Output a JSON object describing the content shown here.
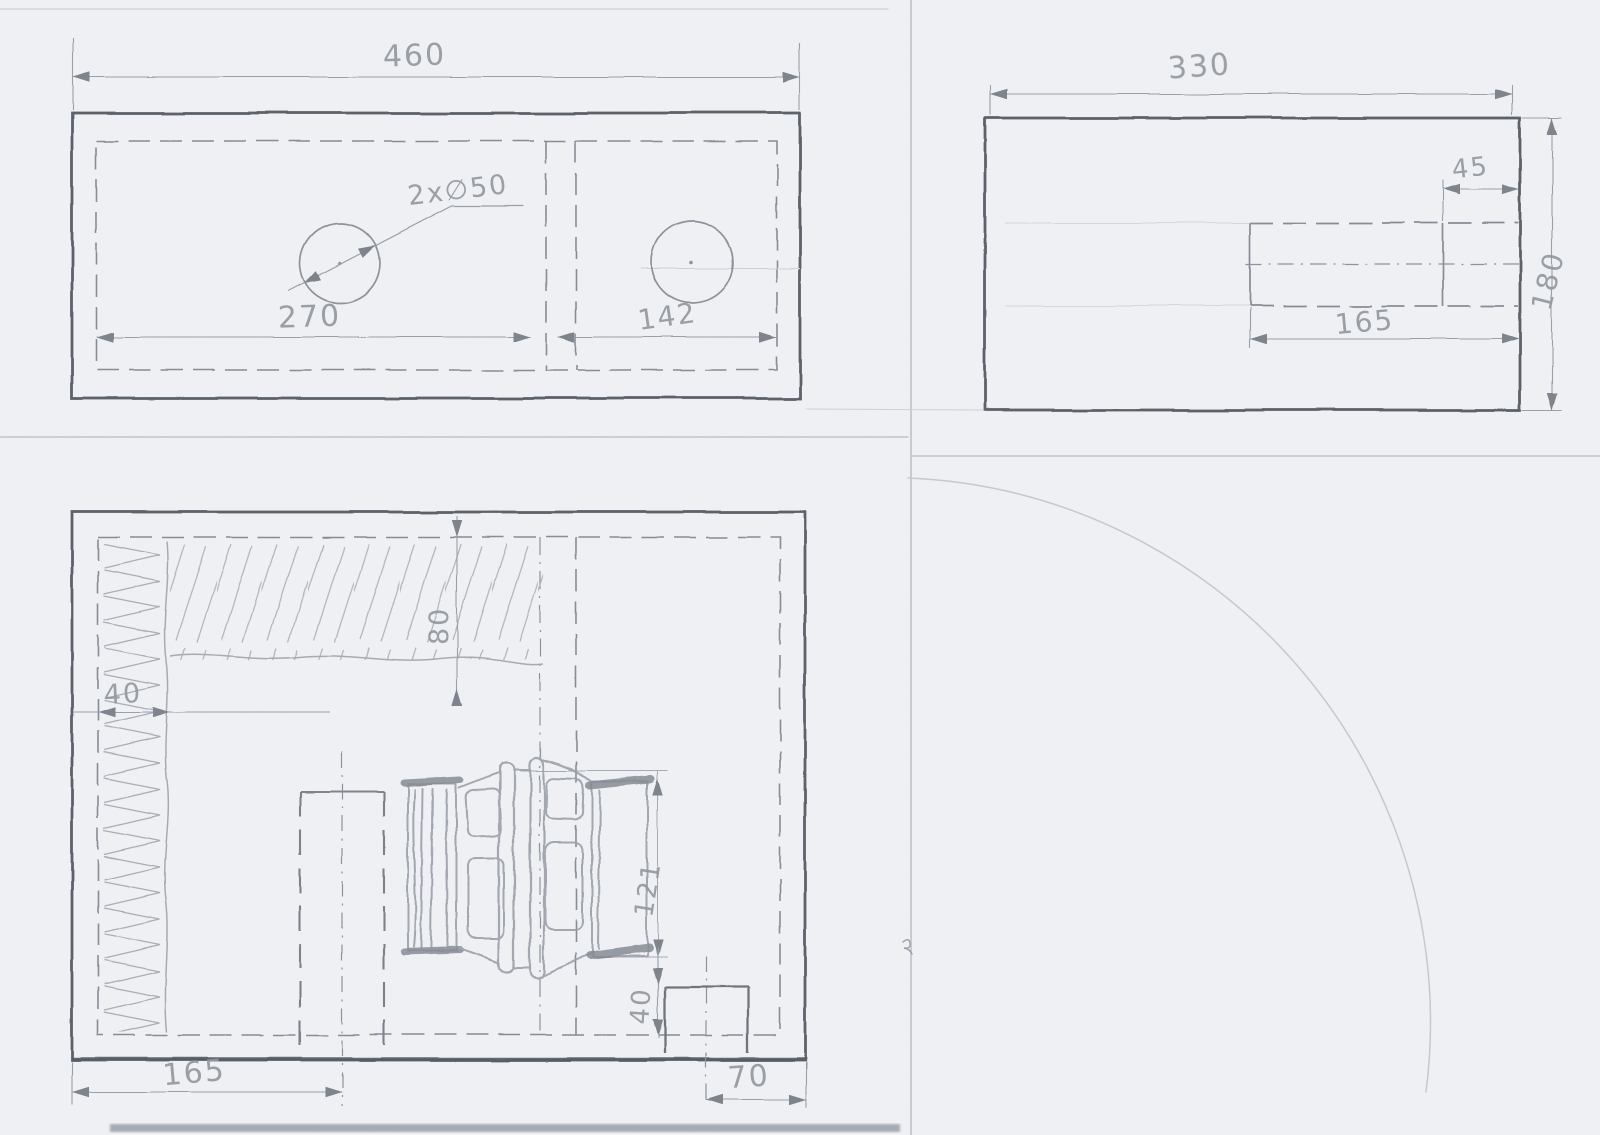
{
  "document": {
    "kind": "hand-drawn pencil technical sketch, three orthographic views of a speaker cabinet"
  },
  "dimensions": {
    "top_view": {
      "overall_width": "460",
      "hole_callout": "2x∅50",
      "left_hole_span": "270",
      "right_hole_span": "142"
    },
    "side_view": {
      "overall_length": "330",
      "port_inner_offset": "45",
      "port_length": "165",
      "overall_height": "180"
    },
    "front_view": {
      "side_lining_width": "40",
      "top_lining_height": "80",
      "port_center_offset": "165",
      "driver_size": "121",
      "corner_slot_height": "40",
      "corner_slot_width": "70"
    }
  },
  "colors": {
    "paper": "#eff1f4",
    "pencil_heavy": "#5d626b",
    "pencil_medium": "#878c95",
    "pencil_light": "#b3b8bf",
    "pencil_text": "#9298a0"
  }
}
